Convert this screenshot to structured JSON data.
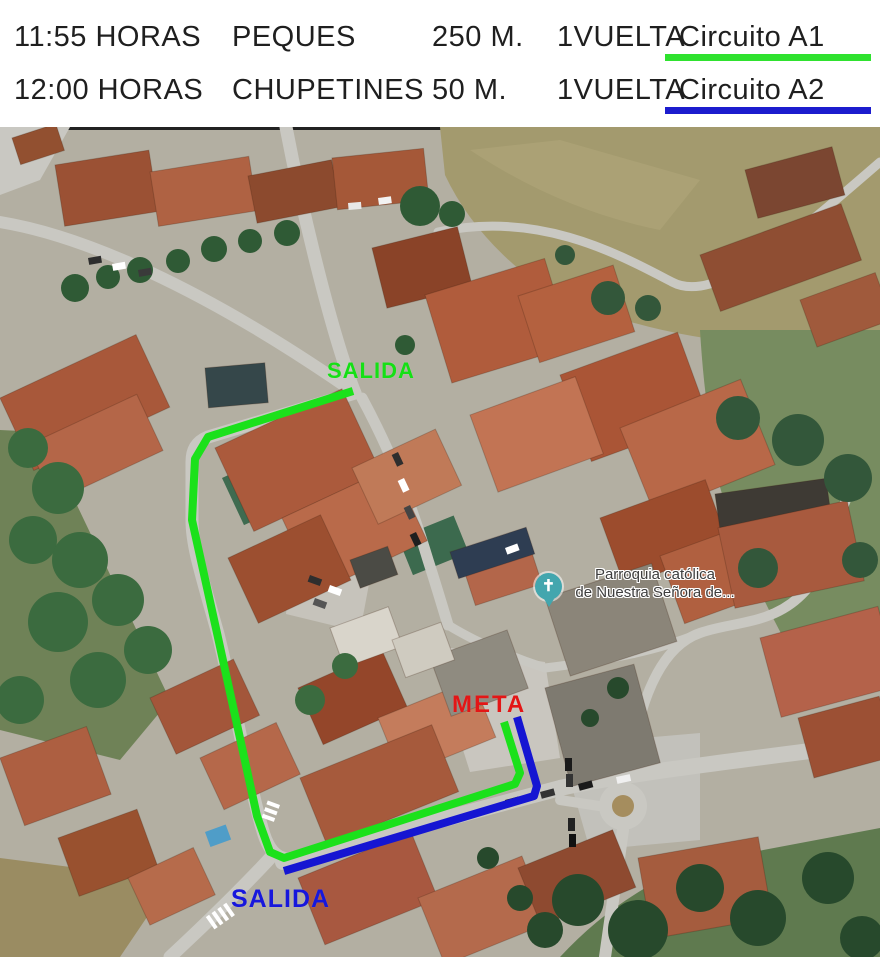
{
  "header": {
    "rows": [
      {
        "time": "11:55 HORAS",
        "category": "PEQUES",
        "distance": "250 M.",
        "laps": "1VUELTA",
        "circuit": "Circuito A1",
        "underline_color": "#2fe22f"
      },
      {
        "time": "12:00 HORAS",
        "category": "CHUPETINES",
        "distance": "50 M.",
        "laps": "1VUELTA",
        "circuit": "Circuito A2",
        "underline_color": "#1c1cce"
      }
    ]
  },
  "map": {
    "labels": {
      "start_a1": {
        "text": "SALIDA",
        "color": "#15e015"
      },
      "finish": {
        "text": "META",
        "color": "#e31616"
      },
      "start_a2": {
        "text": "SALIDA",
        "color": "#1717dc"
      },
      "church": {
        "line1": "Parroquia católica",
        "line2": "de Nuestra Señora de...",
        "marker_color": "#43a6ae",
        "cross_glyph": "✝"
      }
    },
    "routes": {
      "circuit_a1": {
        "color": "#1be11b",
        "points": "353,391 208,437 195,459 192,520 217,633 257,816 270,852 284,858 515,784 520,773 504,722"
      },
      "circuit_a2": {
        "color": "#1515d2",
        "points": "517,717 537,786 534,796 284,871"
      }
    }
  }
}
